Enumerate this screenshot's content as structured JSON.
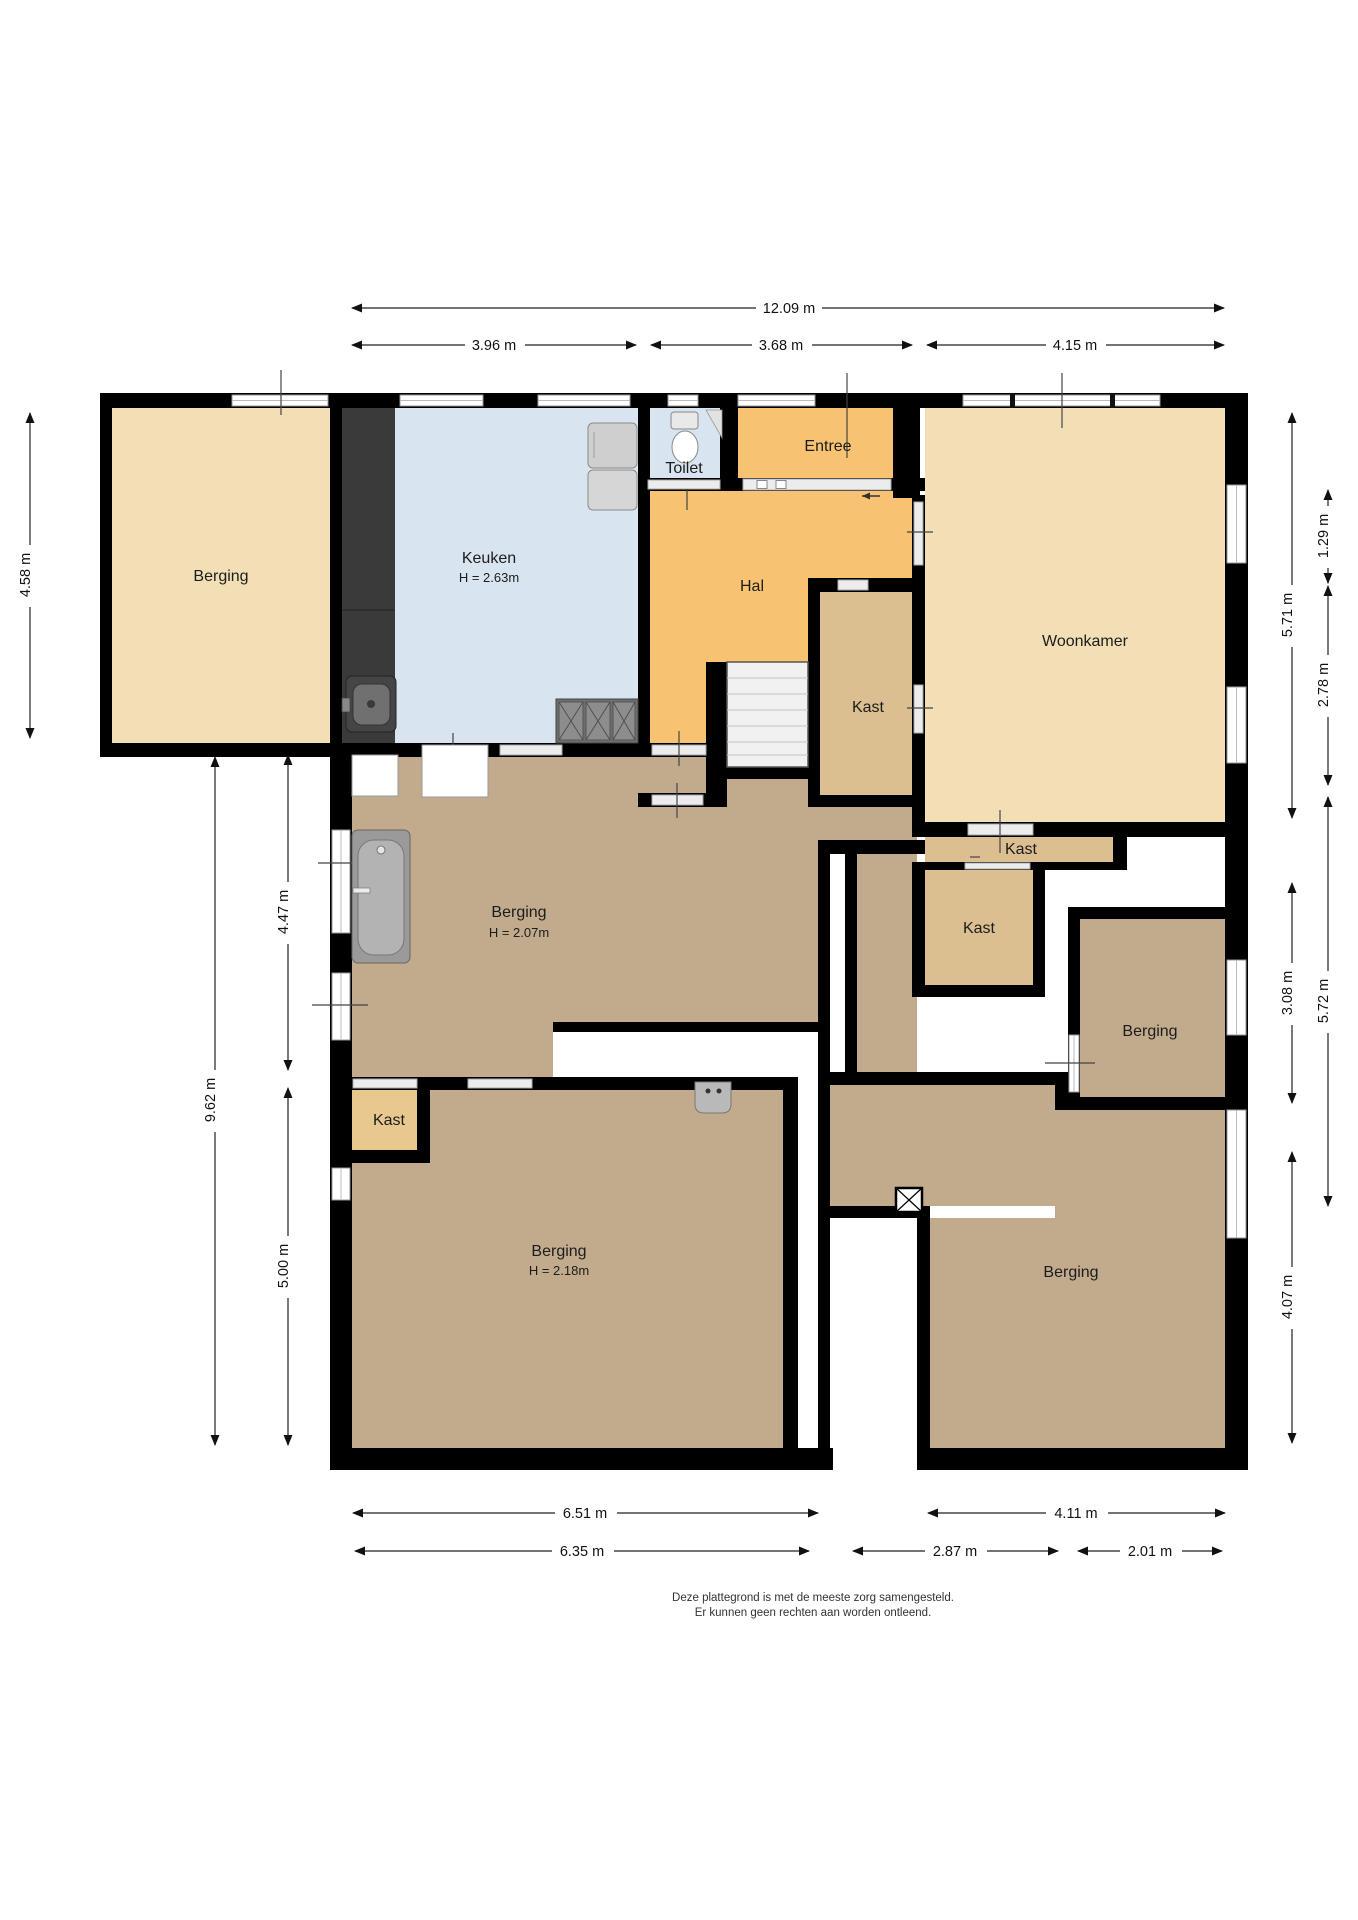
{
  "rooms": {
    "berging_top_left": {
      "label": "Berging"
    },
    "keuken": {
      "label": "Keuken",
      "height": "H = 2.63m"
    },
    "toilet": {
      "label": "Toilet"
    },
    "entree": {
      "label": "Entree"
    },
    "hal": {
      "label": "Hal"
    },
    "kast_hal": {
      "label": "Kast"
    },
    "woonkamer": {
      "label": "Woonkamer"
    },
    "kast_upper": {
      "label": "Kast"
    },
    "kast_lower": {
      "label": "Kast"
    },
    "berging_middle": {
      "label": "Berging",
      "height": "H = 2.07m"
    },
    "berging_right": {
      "label": "Berging"
    },
    "kast_bottom_left": {
      "label": "Kast"
    },
    "berging_bottom_left": {
      "label": "Berging",
      "height": "H = 2.18m"
    },
    "berging_bottom_right": {
      "label": "Berging"
    }
  },
  "dimensions": {
    "top_total": "12.09 m",
    "top_left": "3.96 m",
    "top_middle": "3.68 m",
    "top_right": "4.15 m",
    "left_upper": "4.58 m",
    "left_lower_total": "9.62 m",
    "left_inner_upper": "4.47 m",
    "left_inner_lower": "5.00 m",
    "right_upper_total": "5.71 m",
    "right_upper_inner_1": "1.29 m",
    "right_upper_inner_2": "2.78 m",
    "right_middle_total": "5.72 m",
    "right_middle_inner": "3.08 m",
    "right_lower": "4.07 m",
    "bottom_left_outer": "6.51 m",
    "bottom_left_inner": "6.35 m",
    "bottom_middle_inner": "2.87 m",
    "bottom_right_inner": "2.01 m",
    "bottom_right_outer": "4.11 m"
  },
  "footer": {
    "line1": "Deze plattegrond is met de meeste zorg samengesteld.",
    "line2": "Er kunnen geen rechten aan worden ontleend."
  },
  "colors": {
    "beige": "#f2dfb6",
    "blue": "#d8e5f0",
    "orange": "#f7c271",
    "kast_tan": "#dcbf90",
    "kast_bright": "#e9c88f",
    "brown": "#c2ab8c",
    "dark_strip": "#3a3a3a",
    "wall": "#000000"
  }
}
